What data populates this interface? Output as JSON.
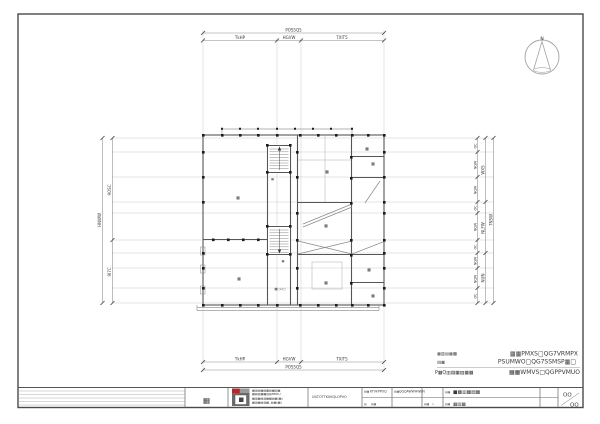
{
  "compass": {
    "north_label": "N"
  },
  "dims": {
    "top": {
      "total": "POS5Q5",
      "segments": [
        "TkHP",
        "HGVW",
        "TXlT5"
      ]
    },
    "bottom": {
      "total": "POS5Q5",
      "segments": [
        "TkHP",
        "HGVW",
        "TXlT5"
      ]
    },
    "left": {
      "total": "HNWW",
      "segments": [
        "9OSC",
        "9I7C"
      ]
    },
    "right": {
      "total": "7NSW",
      "mid": [
        "WX5",
        "NLFW",
        "NUN"
      ],
      "inner": [
        "OC",
        "NQW",
        "NQW",
        "OC",
        "NQW",
        "OC",
        "NQW",
        "NQW",
        "OC"
      ]
    }
  },
  "plan": {
    "rooms": [
      "▦",
      "▦",
      "▦",
      "▦",
      "▦",
      "▦",
      "▦",
      "▦",
      "▦"
    ],
    "stair_up": "▦",
    "stair_down": "▦",
    "stair_door": "▦□▫□"
  },
  "notes": {
    "rows": [
      {
        "label": "▦▥▤▦▩",
        "value": "▦▦PMXS□QG7VRMPX"
      },
      {
        "label": "▤▦",
        "value": "PSUMWO□QG7SSMSP▦□"
      },
      {
        "label": "P▦Q▥▤▦▨▦▦",
        "value": "▦▦WMVS□QGPPVMUO"
      }
    ]
  },
  "title_block": {
    "signature": "▦",
    "firm_lines": [
      "▦▥▤▦▨▩▤▦▥▦",
      "▦▤▨▦▦▥▤MPRU",
      "▦▥▦▤▨▦▦▤▦(▦)",
      "▦▥▦▤▨▦..▤▦(▦)"
    ],
    "center_text": "UILTOTTKUKQLOPVO",
    "f1_label": "▤▦",
    "f1_value": "KTVkPPOQ",
    "f2_label": "▤▦",
    "f2_value": "QQQAWWHWEN",
    "f3_label": "▤",
    "f3_value": "▤▦",
    "f4_label": "▤▦",
    "f4_value": "▫",
    "name_label": "▤▦",
    "name_value": "■▦▥▦▤▦",
    "no_label": "▤▦",
    "no_value": "▦▤▦",
    "sheet_top": "OO",
    "sheet_bottom": "OO"
  },
  "colors": {
    "logo_red": "#b3282d",
    "line_gray": "#565656",
    "grid_gray": "#c9c9c9"
  }
}
